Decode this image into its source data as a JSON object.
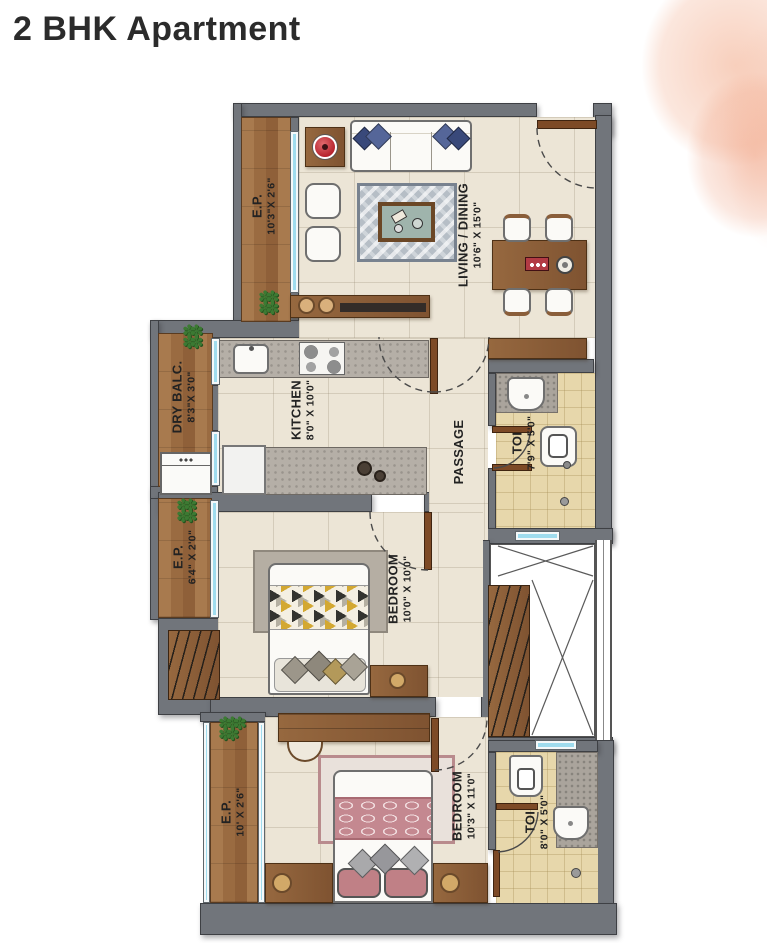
{
  "title": "2 BHK Apartment",
  "rooms": {
    "ep_top": {
      "name": "E.P.",
      "dims": "10'3\"X 2'6\""
    },
    "living_dining": {
      "name": "LIVING / DINING",
      "dims": "10'6\" X 15'0\""
    },
    "dry_balc": {
      "name": "DRY BALC.",
      "dims": "8'3\"X 3'0\""
    },
    "kitchen": {
      "name": "KITCHEN",
      "dims": "8'0\" X 10'0\""
    },
    "passage": {
      "name": "PASSAGE",
      "dims": ""
    },
    "toilet_1": {
      "name": "TOI",
      "dims": "7'9\" X 5'0\""
    },
    "ep_mid": {
      "name": "E.P.",
      "dims": "6'4\" X 2'0\""
    },
    "bedroom_1": {
      "name": "BEDROOM",
      "dims": "10'0\" X 10'0\""
    },
    "ep_bottom": {
      "name": "E.P.",
      "dims": "10' X 2'6\""
    },
    "bedroom_2": {
      "name": "BEDROOM",
      "dims": "10'3\" X 11'0\""
    },
    "toilet_2": {
      "name": "TOI",
      "dims": "8'0\" X 5'0\""
    }
  },
  "palette": {
    "wall": "#71757b",
    "wood_plank": "#9a6b41",
    "furniture_wood": "#8a5e3a",
    "floor_cream": "#ece5d6",
    "bath_tile": "#e7d7ab",
    "window_glass": "#9fdcee",
    "living_rug": "#b6bec6",
    "bed_pink": "#c48890",
    "sofa_pillow_blue": "#4a5c8e",
    "lamp_red": "#c03038",
    "plant_green": "#3c7a33",
    "title_text": "#2b2b2b",
    "watercolor_peach": "#f2a886"
  }
}
